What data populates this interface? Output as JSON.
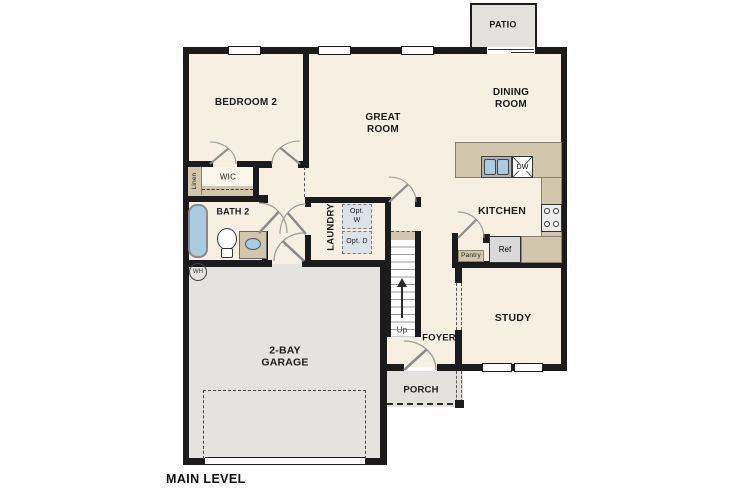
{
  "plan_title": "MAIN LEVEL",
  "rooms": {
    "patio": {
      "label": "PATIO"
    },
    "bedroom2": {
      "label": "BEDROOM 2"
    },
    "great_room": {
      "label": "GREAT ROOM"
    },
    "dining_room": {
      "label": "DINING ROOM"
    },
    "kitchen": {
      "label": "KITCHEN"
    },
    "laundry": {
      "label": "LAUNDRY"
    },
    "wic": {
      "label": "WIC"
    },
    "linen": {
      "label": "Linen"
    },
    "bath2": {
      "label": "BATH 2"
    },
    "study": {
      "label": "STUDY"
    },
    "foyer": {
      "label": "FOYER"
    },
    "porch": {
      "label": "PORCH"
    },
    "garage": {
      "label": "2-BAY GARAGE"
    }
  },
  "fixtures": {
    "dishwasher_label": "DW",
    "refrigerator_label": "Ref",
    "pantry_label": "Pantry",
    "opt_washer_label": "Opt. W",
    "opt_dryer_label": "Opt. D",
    "water_heater_label": "WH",
    "stairs_direction_label": "Up"
  },
  "colors": {
    "floor": "#f7f0e2",
    "counter": "#d2c6ac",
    "garage_floor": "#e4e3e0",
    "outdoor": "#e2e1de",
    "wall": "#1b1b1b",
    "fixture_blue": "#a9cce3"
  }
}
